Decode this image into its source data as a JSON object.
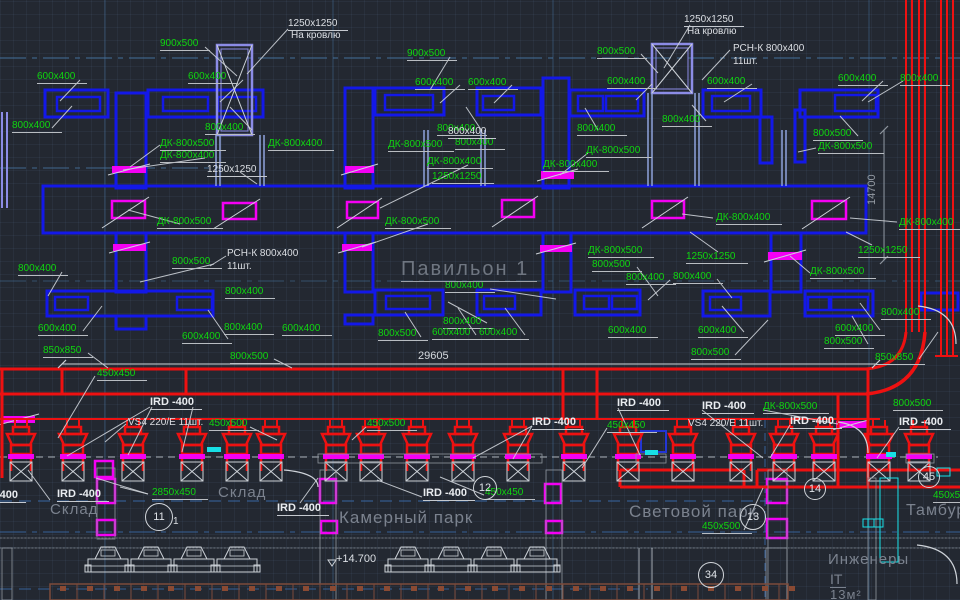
{
  "drawing": {
    "zone_title": "Павильон 1",
    "dimensions": {
      "horizontal": "29605",
      "vertical": "14700"
    },
    "level_mark": "+14.700",
    "colors": {
      "background": "#232831",
      "duct_blue": "#1318e8",
      "duct_red": "#ee1111",
      "damper_magenta": "#f400f4",
      "label_green": "#0fd60f",
      "text_white": "#dcdfe4",
      "room_grey": "#7b828e",
      "shaft_purple": "#8c8ce6",
      "hatch_cyan": "#17e0e6",
      "tray_brown": "#7c4a3a"
    }
  },
  "rooms": [
    {
      "name": "Склад"
    },
    {
      "name": "Склад"
    },
    {
      "name": "Камерный парк"
    },
    {
      "name": "Световой парк"
    },
    {
      "name": "Тамбур"
    },
    {
      "name": "Инженеры"
    },
    {
      "name": "IT"
    },
    {
      "name": "13м²"
    }
  ],
  "axis_circles": [
    {
      "n": "11",
      "x": 145,
      "y": 503,
      "r": 13
    },
    {
      "n": "12",
      "x": 473,
      "y": 476,
      "r": 11
    },
    {
      "n": "13",
      "x": 740,
      "y": 504,
      "r": 12
    },
    {
      "n": "14",
      "x": 804,
      "y": 478,
      "r": 10
    },
    {
      "n": "34",
      "x": 698,
      "y": 562,
      "r": 12
    },
    {
      "n": "45",
      "x": 918,
      "y": 466,
      "r": 10
    }
  ],
  "labels": [
    {
      "t": "900x500",
      "x": 160,
      "y": 38,
      "c": "g"
    },
    {
      "t": "600x400",
      "x": 37,
      "y": 71,
      "c": "g"
    },
    {
      "t": "600x400",
      "x": 188,
      "y": 71,
      "c": "g"
    },
    {
      "t": "800x400",
      "x": 12,
      "y": 120,
      "c": "g"
    },
    {
      "t": "800x400",
      "x": 205,
      "y": 122,
      "c": "g"
    },
    {
      "t": "900x500",
      "x": 407,
      "y": 48,
      "c": "g"
    },
    {
      "t": "600x400",
      "x": 415,
      "y": 77,
      "c": "g"
    },
    {
      "t": "600x400",
      "x": 468,
      "y": 77,
      "c": "g"
    },
    {
      "t": "800x400",
      "x": 437,
      "y": 123,
      "c": "g"
    },
    {
      "t": "800x400",
      "x": 577,
      "y": 123,
      "c": "g"
    },
    {
      "t": "800x500",
      "x": 597,
      "y": 46,
      "c": "g"
    },
    {
      "t": "600x400",
      "x": 607,
      "y": 76,
      "c": "g"
    },
    {
      "t": "600x400",
      "x": 707,
      "y": 76,
      "c": "g"
    },
    {
      "t": "800x400",
      "x": 662,
      "y": 114,
      "c": "g"
    },
    {
      "t": "600x400",
      "x": 838,
      "y": 73,
      "c": "g"
    },
    {
      "t": "800x400",
      "x": 900,
      "y": 73,
      "c": "g"
    },
    {
      "t": "800x500",
      "x": 813,
      "y": 128,
      "c": "g"
    },
    {
      "t": "ДК-800x500",
      "x": 818,
      "y": 141,
      "c": "g"
    },
    {
      "t": "ДК-800x500",
      "x": 160,
      "y": 138,
      "c": "g"
    },
    {
      "t": "ДК-800x400",
      "x": 160,
      "y": 150,
      "c": "g"
    },
    {
      "t": "ДК-800x400",
      "x": 268,
      "y": 138,
      "c": "g"
    },
    {
      "t": "ДК-800x500",
      "x": 157,
      "y": 216,
      "c": "g"
    },
    {
      "t": "ДК-800x500",
      "x": 388,
      "y": 139,
      "c": "g"
    },
    {
      "t": "800x400",
      "x": 455,
      "y": 137,
      "c": "g"
    },
    {
      "t": "ДК-800x400",
      "x": 427,
      "y": 156,
      "c": "g"
    },
    {
      "t": "1250x1250",
      "x": 432,
      "y": 171,
      "c": "g"
    },
    {
      "t": "ДК-800x500",
      "x": 586,
      "y": 145,
      "c": "g"
    },
    {
      "t": "ДК-800x400",
      "x": 543,
      "y": 159,
      "c": "g"
    },
    {
      "t": "ДК-800x500",
      "x": 385,
      "y": 216,
      "c": "g"
    },
    {
      "t": "ДК-800x500",
      "x": 588,
      "y": 245,
      "c": "g"
    },
    {
      "t": "ДК-800x400",
      "x": 716,
      "y": 212,
      "c": "g"
    },
    {
      "t": "ДК-800x400",
      "x": 899,
      "y": 217,
      "c": "g"
    },
    {
      "t": "1250x1250",
      "x": 686,
      "y": 251,
      "c": "g"
    },
    {
      "t": "1250x1250",
      "x": 858,
      "y": 245,
      "c": "g"
    },
    {
      "t": "ДК-800x500",
      "x": 810,
      "y": 266,
      "c": "g"
    },
    {
      "t": "800x400",
      "x": 18,
      "y": 263,
      "c": "g"
    },
    {
      "t": "800x500",
      "x": 172,
      "y": 256,
      "c": "g"
    },
    {
      "t": "800x400",
      "x": 225,
      "y": 286,
      "c": "g"
    },
    {
      "t": "600x400",
      "x": 38,
      "y": 323,
      "c": "g"
    },
    {
      "t": "600x400",
      "x": 182,
      "y": 331,
      "c": "g"
    },
    {
      "t": "800x400",
      "x": 224,
      "y": 322,
      "c": "g"
    },
    {
      "t": "600x400",
      "x": 282,
      "y": 323,
      "c": "g"
    },
    {
      "t": "850x850",
      "x": 43,
      "y": 345,
      "c": "g"
    },
    {
      "t": "800x500",
      "x": 230,
      "y": 351,
      "c": "g"
    },
    {
      "t": "800x400",
      "x": 445,
      "y": 280,
      "c": "g"
    },
    {
      "t": "800x400",
      "x": 443,
      "y": 316,
      "c": "g"
    },
    {
      "t": "800x500",
      "x": 378,
      "y": 328,
      "c": "g"
    },
    {
      "t": "600x400",
      "x": 432,
      "y": 327,
      "c": "g"
    },
    {
      "t": "600x400",
      "x": 479,
      "y": 327,
      "c": "g"
    },
    {
      "t": "800x500",
      "x": 592,
      "y": 259,
      "c": "g"
    },
    {
      "t": "600x400",
      "x": 608,
      "y": 325,
      "c": "g"
    },
    {
      "t": "800x400",
      "x": 626,
      "y": 272,
      "c": "g"
    },
    {
      "t": "800x400",
      "x": 673,
      "y": 271,
      "c": "g"
    },
    {
      "t": "600x400",
      "x": 698,
      "y": 325,
      "c": "g"
    },
    {
      "t": "600x400",
      "x": 835,
      "y": 323,
      "c": "g"
    },
    {
      "t": "800x500",
      "x": 824,
      "y": 336,
      "c": "g"
    },
    {
      "t": "800x500",
      "x": 691,
      "y": 347,
      "c": "g"
    },
    {
      "t": "850x850",
      "x": 875,
      "y": 352,
      "c": "g"
    },
    {
      "t": "800x400",
      "x": 881,
      "y": 307,
      "c": "g"
    },
    {
      "t": "450x450",
      "x": 97,
      "y": 368,
      "c": "g"
    },
    {
      "t": "450x500",
      "x": 209,
      "y": 418,
      "c": "g"
    },
    {
      "t": "450x500",
      "x": 367,
      "y": 418,
      "c": "g"
    },
    {
      "t": "450x450",
      "x": 607,
      "y": 420,
      "c": "g"
    },
    {
      "t": "ДК-800x500",
      "x": 763,
      "y": 401,
      "c": "g"
    },
    {
      "t": "800x500",
      "x": 893,
      "y": 398,
      "c": "g"
    },
    {
      "t": "450x500",
      "x": 702,
      "y": 521,
      "c": "g"
    },
    {
      "t": "450x450",
      "x": 485,
      "y": 487,
      "c": "g"
    },
    {
      "t": "450x500",
      "x": 933,
      "y": 490,
      "c": "g"
    },
    {
      "t": "2850x450",
      "x": 152,
      "y": 487,
      "c": "g"
    },
    {
      "t": "1250x1250",
      "x": 288,
      "y": 18,
      "c": "w"
    },
    {
      "t": "На кровлю",
      "x": 291,
      "y": 30,
      "c": "wn"
    },
    {
      "t": "1250x1250",
      "x": 684,
      "y": 14,
      "c": "w"
    },
    {
      "t": "На кровлю",
      "x": 687,
      "y": 26,
      "c": "wn"
    },
    {
      "t": "РСН-К 800x400",
      "x": 733,
      "y": 43,
      "c": "wn"
    },
    {
      "t": "11шт.",
      "x": 733,
      "y": 56,
      "c": "wn"
    },
    {
      "t": "РСН-К 800x400",
      "x": 227,
      "y": 248,
      "c": "wn"
    },
    {
      "t": "11шт.",
      "x": 227,
      "y": 261,
      "c": "wn"
    },
    {
      "t": "800x400",
      "x": 448,
      "y": 126,
      "c": "w"
    },
    {
      "t": "1250x1250",
      "x": 207,
      "y": 164,
      "c": "w"
    },
    {
      "t": "29605",
      "x": 418,
      "y": 350,
      "c": "dim"
    },
    {
      "t": "14700",
      "x": 866,
      "y": 205,
      "c": "dimv"
    },
    {
      "t": "IRD -400",
      "x": 150,
      "y": 396,
      "c": "ird"
    },
    {
      "t": "IRD -400",
      "x": 57,
      "y": 488,
      "c": "ird"
    },
    {
      "t": "IRD -400",
      "x": 277,
      "y": 502,
      "c": "ird"
    },
    {
      "t": "IRD -400",
      "x": -26,
      "y": 489,
      "c": "ird"
    },
    {
      "t": "IRD -400",
      "x": 423,
      "y": 487,
      "c": "ird"
    },
    {
      "t": "IRD -400",
      "x": 532,
      "y": 416,
      "c": "ird"
    },
    {
      "t": "IRD -400",
      "x": 617,
      "y": 397,
      "c": "ird"
    },
    {
      "t": "IRD -400",
      "x": 702,
      "y": 400,
      "c": "ird"
    },
    {
      "t": "IRD -400",
      "x": 790,
      "y": 415,
      "c": "ird"
    },
    {
      "t": "IRD -400",
      "x": 899,
      "y": 416,
      "c": "ird"
    },
    {
      "t": "VS4 220/E 11шт.",
      "x": 128,
      "y": 417,
      "c": "wn"
    },
    {
      "t": "VS4 220/E 11шт.",
      "x": 688,
      "y": 418,
      "c": "wn"
    },
    {
      "t": "+14.700",
      "x": 336,
      "y": 553,
      "c": "wn",
      "s": 11
    },
    {
      "t": "1",
      "x": 173,
      "y": 516,
      "c": "wn"
    },
    {
      "t": "Склад",
      "x": 50,
      "y": 501,
      "c": "room",
      "s": 15
    },
    {
      "t": "Склад",
      "x": 218,
      "y": 484,
      "c": "room",
      "s": 15
    },
    {
      "t": "Камерный парк",
      "x": 339,
      "y": 508,
      "c": "room",
      "s": 17
    },
    {
      "t": "Световой парк",
      "x": 629,
      "y": 502,
      "c": "room",
      "s": 17
    },
    {
      "t": "Тамбур",
      "x": 906,
      "y": 502,
      "c": "room",
      "s": 16
    },
    {
      "t": "Инженеры",
      "x": 828,
      "y": 551,
      "c": "room",
      "s": 15
    },
    {
      "t": "IT",
      "x": 830,
      "y": 571,
      "c": "itu",
      "s": 14
    },
    {
      "t": "13м²",
      "x": 830,
      "y": 588,
      "c": "room",
      "s": 13
    },
    {
      "t": "Павильон 1",
      "x": 401,
      "y": 258,
      "c": "big"
    }
  ]
}
